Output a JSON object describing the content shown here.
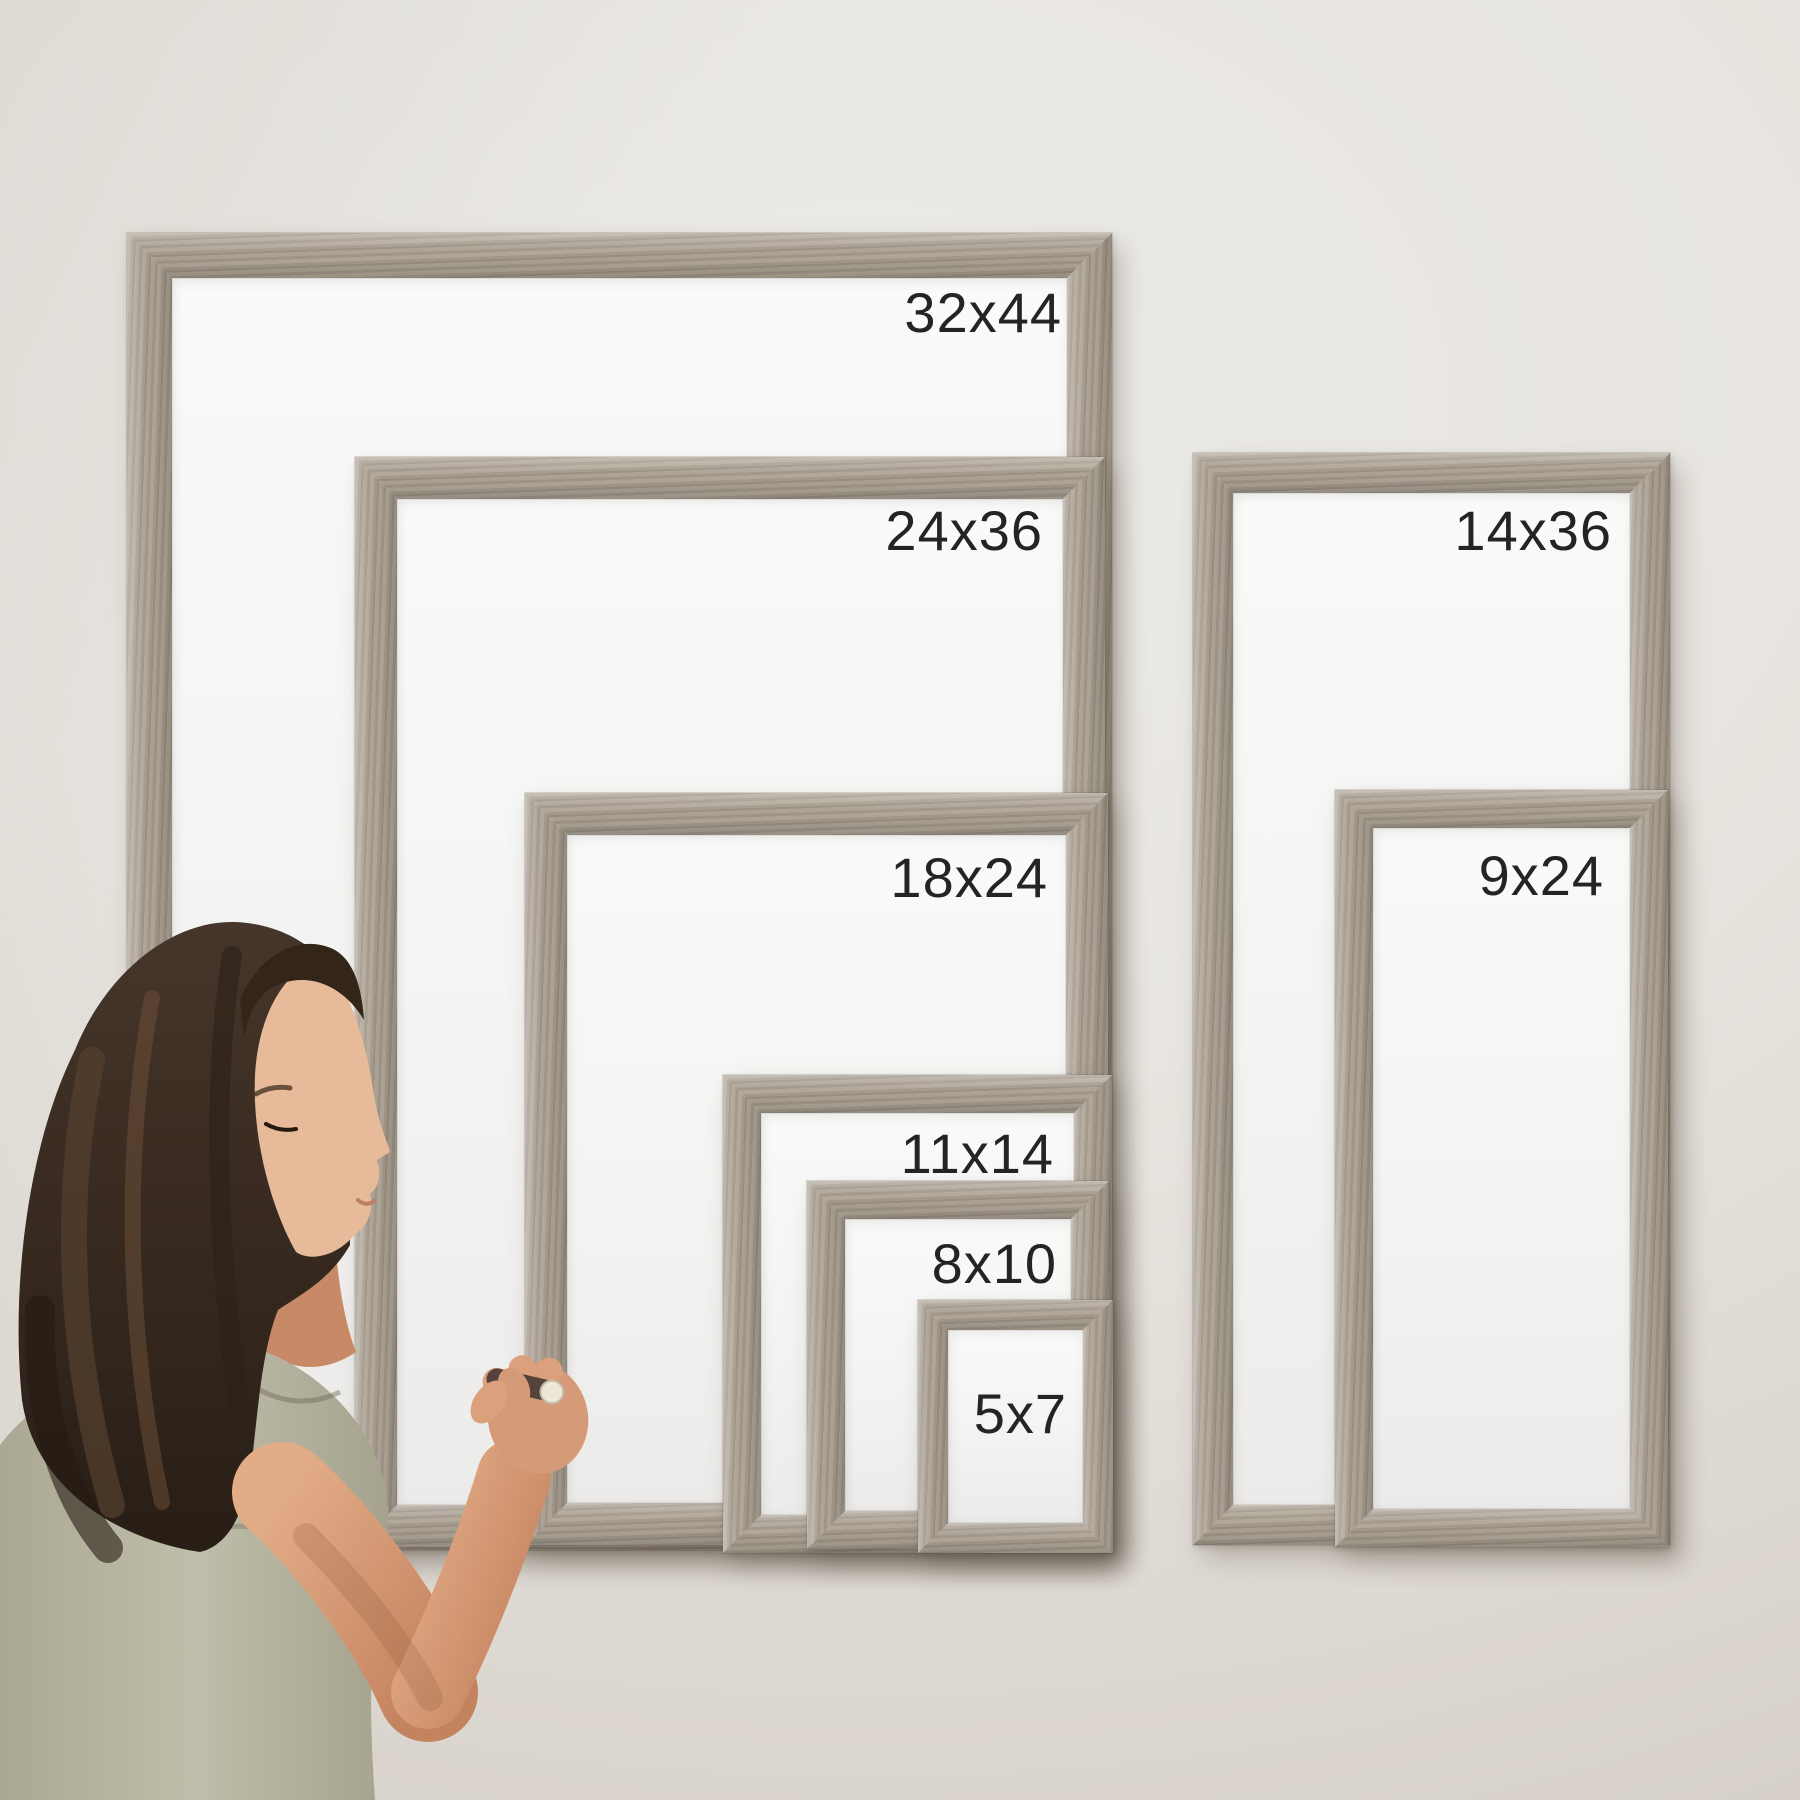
{
  "photo": {
    "subject": "frame size comparison wall display",
    "board_count": 8
  },
  "frames": [
    {
      "label": "32x44",
      "x": 127,
      "y": 233,
      "w": 985,
      "h": 1317,
      "bar": 45,
      "label_top": 52,
      "label_right": 50
    },
    {
      "label": "24x36",
      "x": 355,
      "y": 457,
      "w": 750,
      "h": 1090,
      "bar": 42,
      "label_top": 46,
      "label_right": 62
    },
    {
      "label": "18x24",
      "x": 525,
      "y": 793,
      "w": 583,
      "h": 752,
      "bar": 42,
      "label_top": 57,
      "label_right": 60
    },
    {
      "label": "11x14",
      "x": 723,
      "y": 1075,
      "w": 389,
      "h": 478,
      "bar": 38,
      "label_top": 51,
      "label_right": 58
    },
    {
      "label": "8x10",
      "x": 807,
      "y": 1181,
      "w": 302,
      "h": 368,
      "bar": 38,
      "label_top": 55,
      "label_right": 52
    },
    {
      "label": "5x7",
      "x": 918,
      "y": 1300,
      "w": 195,
      "h": 253,
      "bar": 30,
      "label_top": 86,
      "label_right": 46
    },
    {
      "label": "14x36",
      "x": 1193,
      "y": 453,
      "w": 477,
      "h": 1092,
      "bar": 40,
      "label_top": 50,
      "label_right": 58
    },
    {
      "label": "9x24",
      "x": 1335,
      "y": 790,
      "w": 333,
      "h": 757,
      "bar": 38,
      "label_top": 58,
      "label_right": 64
    }
  ],
  "colors": {
    "wall": "#e7e3dd",
    "wall_shadowed": "#d2ccc3",
    "board_surface": "#f4f4f2",
    "wood_base": "#a89e90",
    "wood_light": "#b2a89a",
    "wood_dark": "#9a9083",
    "label_text": "#242424",
    "hair": "#392c21",
    "skin": "#d0936f",
    "shirt": "#b6b5a1",
    "marker_body": "#54433a",
    "marker_cap": "#eee6d6"
  }
}
